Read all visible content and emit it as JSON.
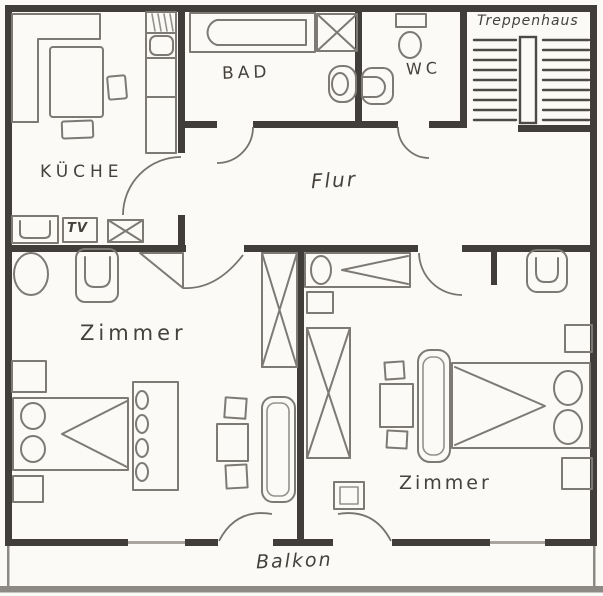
{
  "title": "Hand-drawn apartment floor plan",
  "colors": {
    "paper": "#fbfaf7",
    "wall": "#403d3a",
    "furniture_stroke": "#7d7a76",
    "text": "#45423e",
    "balcony_edge": "#8d8a85"
  },
  "rooms": {
    "kitchen": {
      "label": "KÜCHE",
      "tv_label": "TV",
      "furniture": [
        "corner-bench",
        "dining-table",
        "chair",
        "chair",
        "kitchen-unit-with-sink",
        "sideboard",
        "tv-stand",
        "crate"
      ]
    },
    "bathroom": {
      "label": "BAD",
      "furniture": [
        "bathtub",
        "shower",
        "washbasin"
      ]
    },
    "wc": {
      "label": "WC",
      "furniture": [
        "toilet",
        "washbasin"
      ]
    },
    "stairwell": {
      "label": "Treppenhaus",
      "furniture": [
        "stair-flight-left",
        "landing",
        "stair-flight-right"
      ]
    },
    "hallway": {
      "label": "Flur",
      "furniture": []
    },
    "bedroom_left": {
      "label": "Zimmer",
      "furniture": [
        "round-chair",
        "armchair",
        "nightstand",
        "double-bed",
        "nightstand",
        "wardrobe",
        "x-cabinet",
        "sofa",
        "table",
        "chair",
        "chair"
      ]
    },
    "bedroom_right": {
      "label": "Zimmer",
      "furniture": [
        "daybed",
        "cabinet",
        "x-cabinet",
        "small-cabinet",
        "sofa",
        "double-bed",
        "nightstand",
        "wall-shelf",
        "table",
        "chair",
        "chair",
        "armchair"
      ]
    },
    "balcony": {
      "label": "Balkon",
      "furniture": []
    }
  }
}
